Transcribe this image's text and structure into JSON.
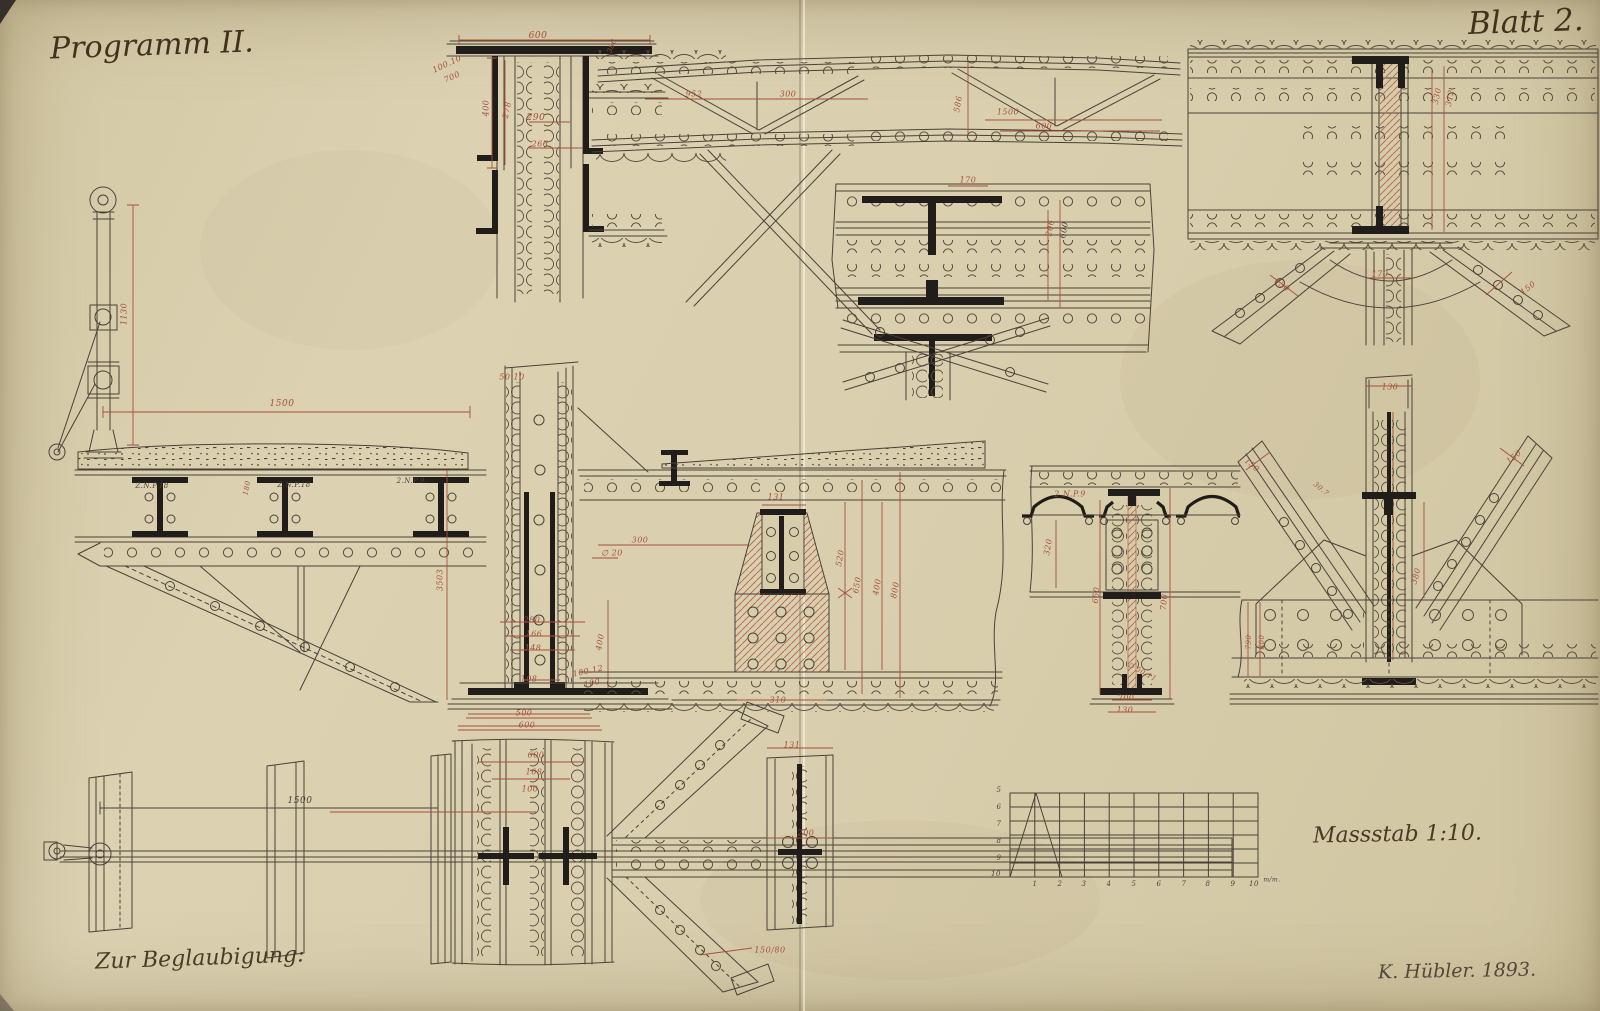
{
  "page": {
    "title": "Programm II.",
    "sheet": "Blatt 2.",
    "scale_label": "Massstab 1:10.",
    "certification": "Zur Beglaubigung:",
    "signature": "K. Hübler. 1893."
  },
  "colors": {
    "paper": "#d9cfae",
    "ink": "#4a4238",
    "section_black": "#201d1a",
    "dimension_red": "#a5503b",
    "hatch_red": "#b4624d"
  },
  "annotations": [
    {
      "x": 538,
      "y": 36,
      "text": "600",
      "color": "red",
      "size": 9
    },
    {
      "x": 447,
      "y": 64,
      "text": "100.10",
      "color": "red",
      "rot": -25,
      "size": 8
    },
    {
      "x": 452,
      "y": 77,
      "text": "700",
      "color": "red",
      "rot": -25,
      "size": 8
    },
    {
      "x": 486,
      "y": 108,
      "text": "400",
      "color": "red",
      "rot": -90,
      "size": 8
    },
    {
      "x": 507,
      "y": 110,
      "text": "278",
      "color": "red",
      "rot": -78,
      "size": 8
    },
    {
      "x": 536,
      "y": 118,
      "text": "290",
      "color": "red",
      "size": 9
    },
    {
      "x": 540,
      "y": 144,
      "text": "266",
      "color": "red",
      "size": 8
    },
    {
      "x": 612,
      "y": 46,
      "text": "380",
      "color": "red",
      "rot": -70,
      "size": 7
    },
    {
      "x": 694,
      "y": 94,
      "text": "952",
      "color": "red",
      "size": 8
    },
    {
      "x": 788,
      "y": 94,
      "text": "300",
      "color": "red",
      "size": 8
    },
    {
      "x": 958,
      "y": 104,
      "text": "586",
      "color": "red",
      "rot": -80,
      "size": 8
    },
    {
      "x": 1008,
      "y": 112,
      "text": "1500",
      "color": "red",
      "size": 8
    },
    {
      "x": 1044,
      "y": 126,
      "text": "600",
      "color": "red",
      "size": 8
    },
    {
      "x": 968,
      "y": 180,
      "text": "170",
      "color": "red",
      "size": 8
    },
    {
      "x": 1050,
      "y": 228,
      "text": "206",
      "color": "red",
      "rot": -80,
      "size": 8
    },
    {
      "x": 1064,
      "y": 230,
      "text": "600",
      "color": "ink",
      "rot": -80,
      "size": 8
    },
    {
      "x": 1437,
      "y": 96,
      "text": "330",
      "color": "red",
      "rot": -78,
      "size": 8
    },
    {
      "x": 1450,
      "y": 98,
      "text": "312",
      "color": "red",
      "rot": -78,
      "size": 8
    },
    {
      "x": 1380,
      "y": 274,
      "text": "170",
      "color": "red",
      "size": 8
    },
    {
      "x": 1282,
      "y": 285,
      "text": "130",
      "color": "red",
      "rot": 38,
      "size": 8
    },
    {
      "x": 1528,
      "y": 288,
      "text": "150",
      "color": "red",
      "rot": -38,
      "size": 8
    },
    {
      "x": 124,
      "y": 314,
      "text": "1130",
      "color": "red",
      "rot": -90,
      "size": 8
    },
    {
      "x": 282,
      "y": 404,
      "text": "1500",
      "color": "red",
      "size": 9
    },
    {
      "x": 152,
      "y": 486,
      "text": "Z.N.P.18",
      "color": "ink",
      "size": 7
    },
    {
      "x": 294,
      "y": 485,
      "text": "Z.N.P.18",
      "color": "ink",
      "size": 7
    },
    {
      "x": 412,
      "y": 481,
      "text": "2.N.P.9.",
      "color": "ink",
      "size": 7
    },
    {
      "x": 247,
      "y": 488,
      "text": "180",
      "color": "red",
      "rot": -80,
      "size": 7
    },
    {
      "x": 512,
      "y": 377,
      "text": "50.10",
      "color": "red",
      "size": 8
    },
    {
      "x": 440,
      "y": 580,
      "text": "3503",
      "color": "red",
      "rot": -90,
      "size": 8
    },
    {
      "x": 640,
      "y": 540,
      "text": "300",
      "color": "red",
      "size": 8
    },
    {
      "x": 612,
      "y": 553,
      "text": "∅ 20",
      "color": "red",
      "size": 8
    },
    {
      "x": 532,
      "y": 620,
      "text": "280",
      "color": "red",
      "size": 8
    },
    {
      "x": 534,
      "y": 634,
      "text": "166",
      "color": "red",
      "size": 8
    },
    {
      "x": 533,
      "y": 648,
      "text": "148",
      "color": "red",
      "size": 8
    },
    {
      "x": 600,
      "y": 642,
      "text": "400",
      "color": "red",
      "rot": -80,
      "size": 8
    },
    {
      "x": 529,
      "y": 679,
      "text": "108",
      "color": "red",
      "size": 8
    },
    {
      "x": 588,
      "y": 671,
      "text": "100.12",
      "color": "red",
      "rot": -12,
      "size": 8
    },
    {
      "x": 592,
      "y": 683,
      "text": "100",
      "color": "red",
      "rot": -12,
      "size": 8
    },
    {
      "x": 524,
      "y": 713,
      "text": "500",
      "color": "red",
      "size": 8
    },
    {
      "x": 527,
      "y": 725,
      "text": "600",
      "color": "red",
      "size": 8
    },
    {
      "x": 776,
      "y": 497,
      "text": "131",
      "color": "red",
      "size": 8
    },
    {
      "x": 778,
      "y": 700,
      "text": "310",
      "color": "red",
      "size": 8
    },
    {
      "x": 840,
      "y": 558,
      "text": "520",
      "color": "red",
      "rot": -80,
      "size": 8
    },
    {
      "x": 857,
      "y": 585,
      "text": "650",
      "color": "red",
      "rot": -80,
      "size": 8
    },
    {
      "x": 877,
      "y": 587,
      "text": "400",
      "color": "red",
      "rot": -80,
      "size": 8
    },
    {
      "x": 895,
      "y": 590,
      "text": "800",
      "color": "red",
      "rot": -80,
      "size": 8
    },
    {
      "x": 1070,
      "y": 494,
      "text": "2.N.P.9",
      "color": "red",
      "size": 8
    },
    {
      "x": 1048,
      "y": 547,
      "text": "320",
      "color": "red",
      "rot": -80,
      "size": 8
    },
    {
      "x": 1096,
      "y": 595,
      "text": "650",
      "color": "red",
      "rot": -85,
      "size": 8
    },
    {
      "x": 1164,
      "y": 602,
      "text": "700",
      "color": "red",
      "rot": -85,
      "size": 8
    },
    {
      "x": 1142,
      "y": 672,
      "text": "∅ 50.11",
      "color": "red",
      "rot": 28,
      "size": 7
    },
    {
      "x": 1126,
      "y": 698,
      "text": "200",
      "color": "red",
      "size": 8
    },
    {
      "x": 1125,
      "y": 710,
      "text": "130",
      "color": "red",
      "size": 8
    },
    {
      "x": 1390,
      "y": 387,
      "text": "130",
      "color": "red",
      "size": 8
    },
    {
      "x": 1252,
      "y": 465,
      "text": "150",
      "color": "red",
      "rot": 40,
      "size": 8
    },
    {
      "x": 1514,
      "y": 457,
      "text": "150",
      "color": "red",
      "rot": -40,
      "size": 8
    },
    {
      "x": 1321,
      "y": 489,
      "text": "30.7",
      "color": "red",
      "rot": 40,
      "size": 7
    },
    {
      "x": 1416,
      "y": 576,
      "text": "380",
      "color": "red",
      "rot": -75,
      "size": 8
    },
    {
      "x": 1249,
      "y": 642,
      "text": "790",
      "color": "red",
      "rot": -90,
      "size": 7
    },
    {
      "x": 1262,
      "y": 642,
      "text": "600",
      "color": "red",
      "rot": -90,
      "size": 7
    },
    {
      "x": 300,
      "y": 801,
      "text": "1500",
      "color": "ink",
      "size": 9
    },
    {
      "x": 536,
      "y": 755,
      "text": "600",
      "color": "red",
      "size": 8
    },
    {
      "x": 534,
      "y": 772,
      "text": "168",
      "color": "red",
      "size": 8
    },
    {
      "x": 530,
      "y": 789,
      "text": "100",
      "color": "red",
      "size": 8
    },
    {
      "x": 792,
      "y": 745,
      "text": "131",
      "color": "red",
      "size": 8
    },
    {
      "x": 806,
      "y": 833,
      "text": "200",
      "color": "red",
      "size": 8
    },
    {
      "x": 770,
      "y": 950,
      "text": "150/80",
      "color": "red",
      "size": 8
    },
    {
      "x": 999,
      "y": 790,
      "text": "5",
      "color": "ink",
      "size": 7
    },
    {
      "x": 999,
      "y": 807,
      "text": "6",
      "color": "ink",
      "size": 7
    },
    {
      "x": 999,
      "y": 824,
      "text": "7",
      "color": "ink",
      "size": 7
    },
    {
      "x": 999,
      "y": 841,
      "text": "8",
      "color": "ink",
      "size": 7
    },
    {
      "x": 999,
      "y": 858,
      "text": "9",
      "color": "ink",
      "size": 7
    },
    {
      "x": 996,
      "y": 874,
      "text": "10",
      "color": "ink",
      "size": 7
    },
    {
      "x": 1035,
      "y": 884,
      "text": "1",
      "color": "ink",
      "size": 7
    },
    {
      "x": 1060,
      "y": 884,
      "text": "2",
      "color": "ink",
      "size": 7
    },
    {
      "x": 1084,
      "y": 884,
      "text": "3",
      "color": "ink",
      "size": 7
    },
    {
      "x": 1109,
      "y": 884,
      "text": "4",
      "color": "ink",
      "size": 7
    },
    {
      "x": 1134,
      "y": 884,
      "text": "5",
      "color": "ink",
      "size": 7
    },
    {
      "x": 1159,
      "y": 884,
      "text": "6",
      "color": "ink",
      "size": 7
    },
    {
      "x": 1184,
      "y": 884,
      "text": "7",
      "color": "ink",
      "size": 7
    },
    {
      "x": 1208,
      "y": 884,
      "text": "8",
      "color": "ink",
      "size": 7
    },
    {
      "x": 1233,
      "y": 884,
      "text": "9",
      "color": "ink",
      "size": 7
    },
    {
      "x": 1254,
      "y": 884,
      "text": "10",
      "color": "ink",
      "size": 7
    },
    {
      "x": 1272,
      "y": 880,
      "text": "m/m.",
      "color": "ink",
      "size": 6
    }
  ]
}
